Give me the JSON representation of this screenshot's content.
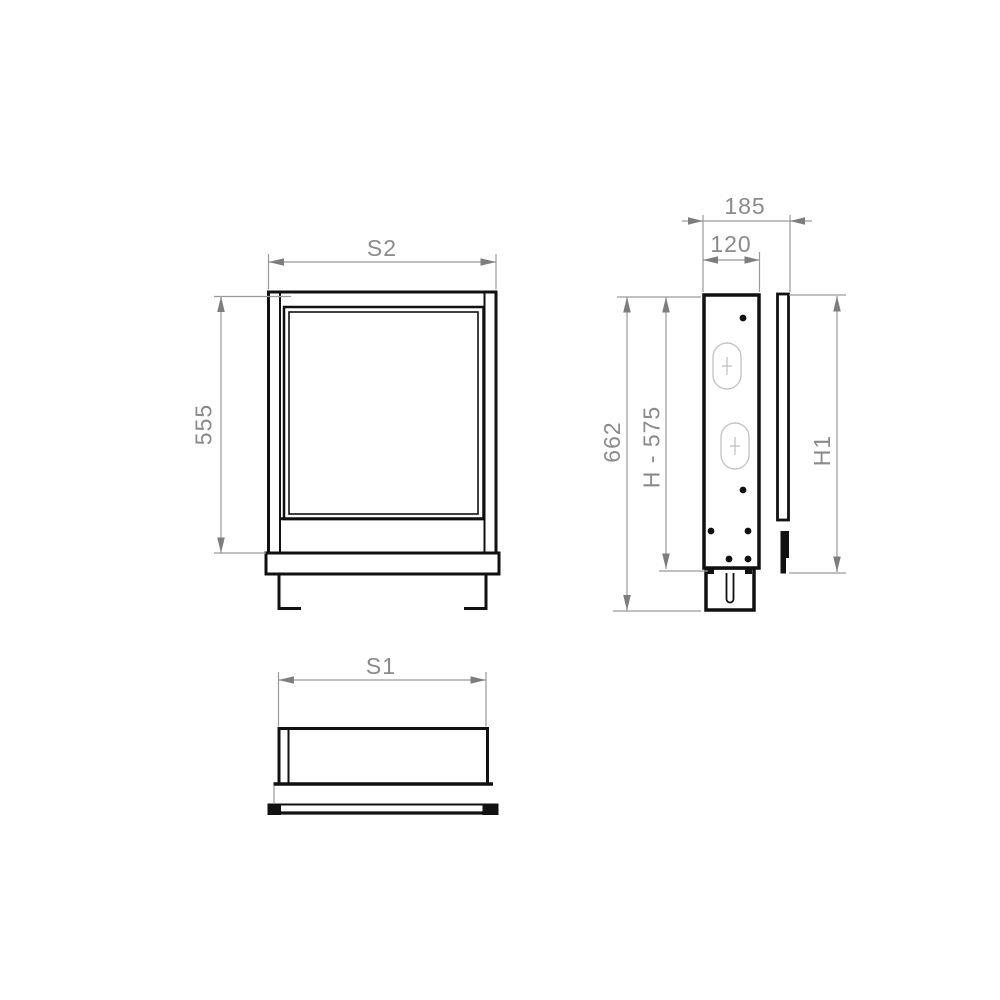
{
  "drawing": {
    "front_view": {
      "width_dim": "S2",
      "height_dim": "555"
    },
    "side_view": {
      "overall_depth_dim": "185",
      "body_depth_dim": "120",
      "overall_height_dim": "662",
      "body_height_dim": "H - 575",
      "front_panel_height_dim": "H1"
    },
    "plan_view": {
      "width_dim": "S1"
    }
  },
  "colors": {
    "background": "#ffffff",
    "outline": "#111111",
    "dimension_line": "#9a9a9a",
    "dimension_text": "#8a8a8a",
    "arrow_fill": "#7d7d7d",
    "detail_outline": "#c6c6c6"
  }
}
